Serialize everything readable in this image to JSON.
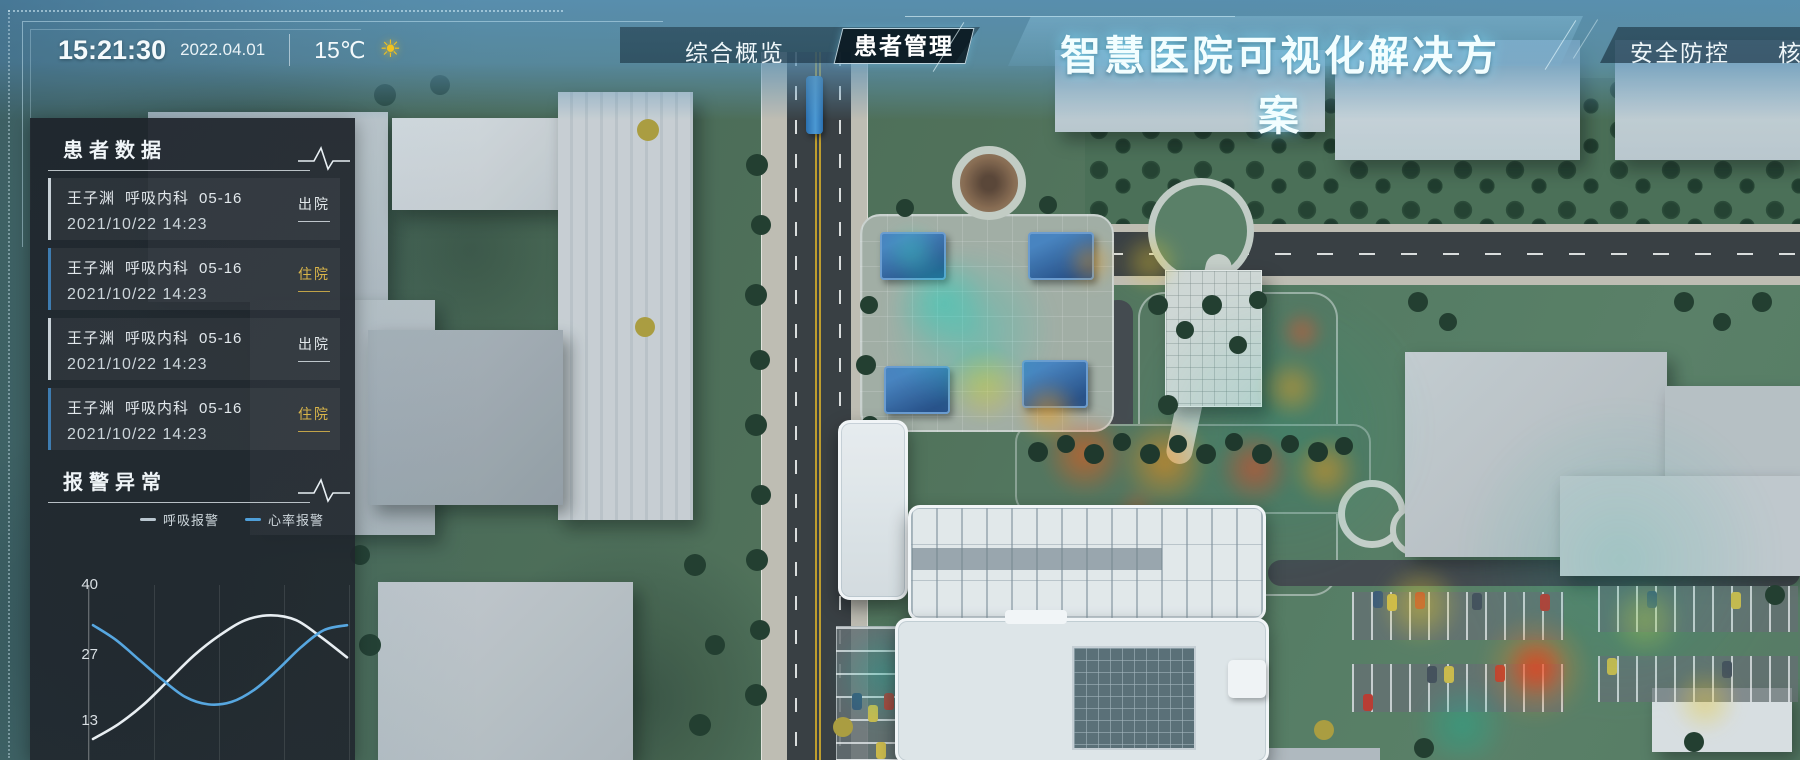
{
  "colors": {
    "accent_cyan": "#7fdcf0",
    "badge_discharged": "#e3e9ec",
    "badge_inpatient": "#d9b54a",
    "border_discharged": "#c9d2d8",
    "border_inpatient": "#3e7cb0"
  },
  "header": {
    "time": "15:21:30",
    "date": "2022.04.01",
    "temperature": "15℃",
    "weather_icon": "sun-icon",
    "title": "智慧医院可视化解决方案",
    "tabs_left": [
      {
        "label": "综合概览",
        "active": false
      },
      {
        "label": "患者管理",
        "active": true
      }
    ],
    "tabs_right": [
      {
        "label": "安全防控",
        "active": false
      },
      {
        "label": "核",
        "active": false
      }
    ]
  },
  "patient_panel": {
    "title": "患者数据",
    "items": [
      {
        "name": "王子渊",
        "dept": "呼吸内科",
        "bed": "05-16",
        "time": "2021/10/22 14:23",
        "status": "出院"
      },
      {
        "name": "王子渊",
        "dept": "呼吸内科",
        "bed": "05-16",
        "time": "2021/10/22 14:23",
        "status": "住院"
      },
      {
        "name": "王子渊",
        "dept": "呼吸内科",
        "bed": "05-16",
        "time": "2021/10/22 14:23",
        "status": "出院"
      },
      {
        "name": "王子渊",
        "dept": "呼吸内科",
        "bed": "05-16",
        "time": "2021/10/22 14:23",
        "status": "住院"
      }
    ]
  },
  "alarm_panel": {
    "title": "报警异常",
    "legend": [
      {
        "label": "呼吸报警",
        "color": "#b9c6cf"
      },
      {
        "label": "心率报警",
        "color": "#4f9fd9"
      }
    ]
  },
  "chart_data": {
    "type": "line",
    "title": "报警异常",
    "xlabel": "",
    "ylabel": "",
    "ylim": [
      0,
      40
    ],
    "yticks": [
      40,
      27,
      13
    ],
    "grid": "vertical",
    "legend_position": "top",
    "series": [
      {
        "name": "呼吸报警",
        "color": "#e8eef2",
        "values": [
          10.5,
          13.5,
          17.5,
          22.5,
          27.5,
          31.5,
          34.5,
          35.5,
          34.5,
          31,
          27
        ]
      },
      {
        "name": "心率报警",
        "color": "#57a7e0",
        "values": [
          33.5,
          30.5,
          26.5,
          22.5,
          19,
          17.5,
          18,
          20.5,
          24.5,
          29,
          32.5,
          33.5
        ]
      }
    ]
  }
}
